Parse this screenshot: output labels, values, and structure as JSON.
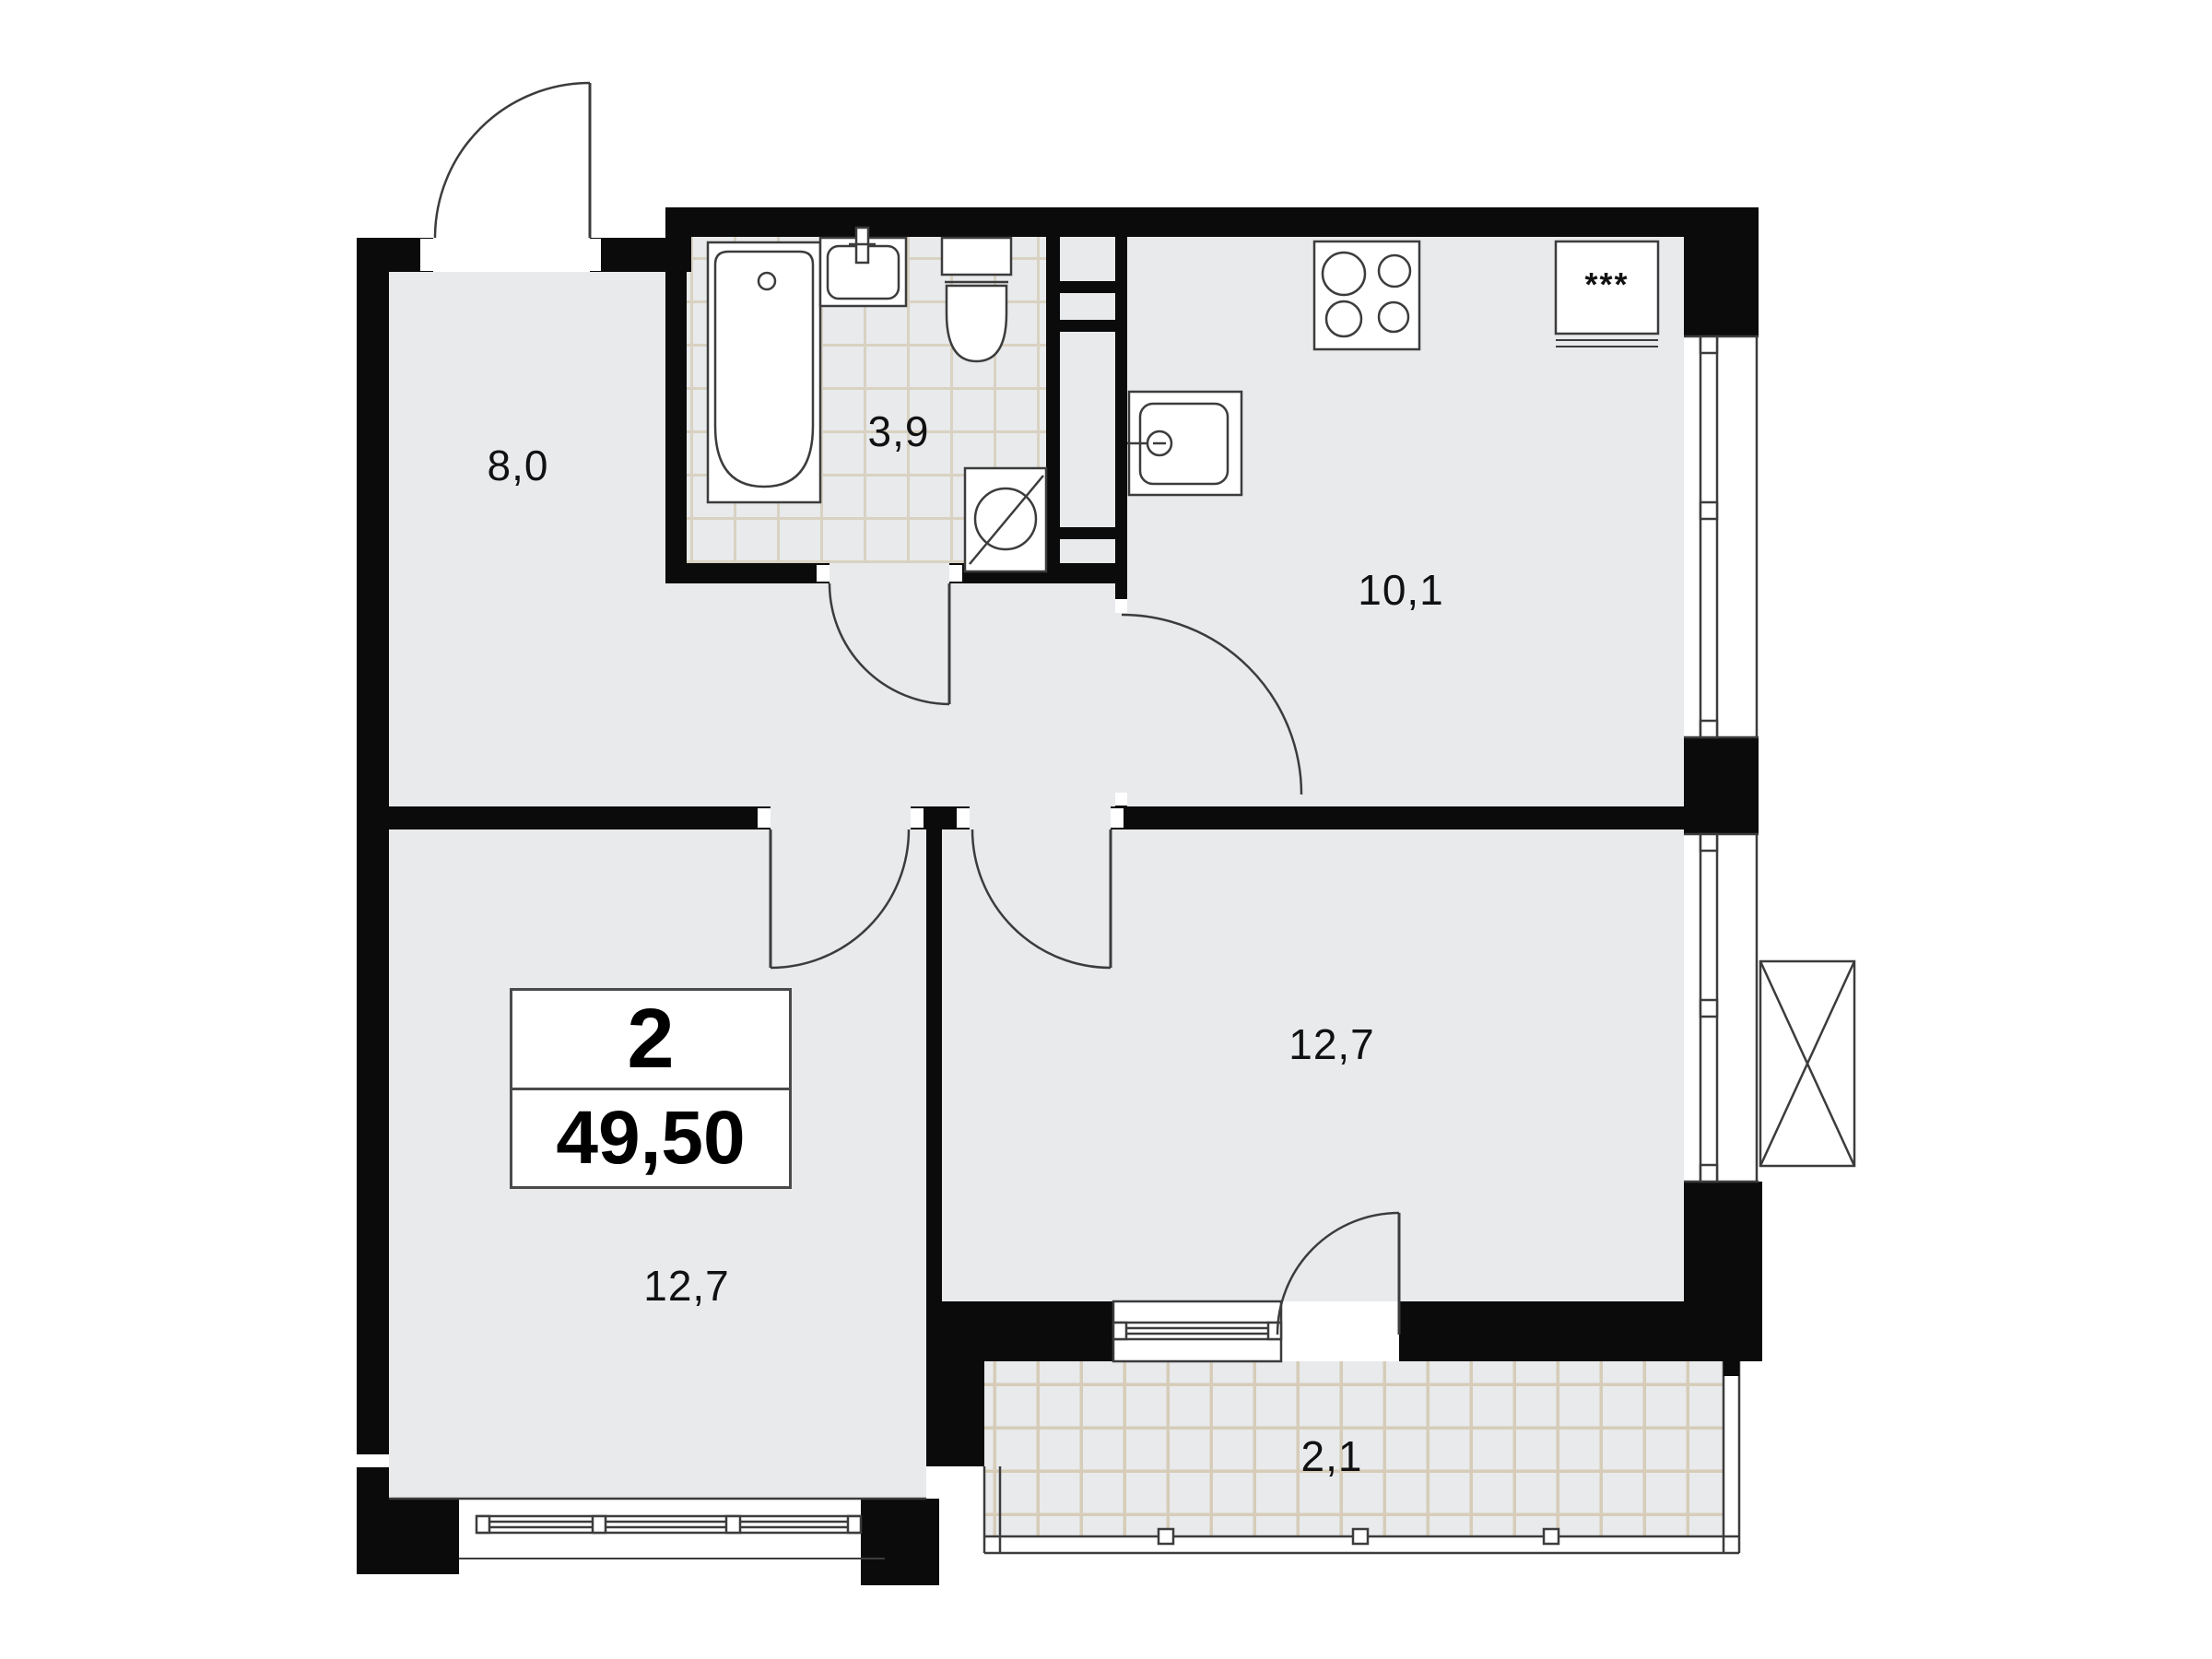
{
  "plan": {
    "title": "2-room apartment floor plan",
    "apartment": {
      "rooms_count": "2",
      "total_area": "49,50"
    },
    "rooms": [
      {
        "id": "hallway",
        "area_label": "8,0"
      },
      {
        "id": "bathroom",
        "area_label": "3,9"
      },
      {
        "id": "kitchen",
        "area_label": "10,1"
      },
      {
        "id": "living-room",
        "area_label": "12,7"
      },
      {
        "id": "bedroom",
        "area_label": "12,7"
      },
      {
        "id": "balcony",
        "area_label": "2,1"
      }
    ],
    "fixtures": {
      "fridge_label": "***"
    },
    "colors": {
      "wall": "#0b0b0b",
      "floor": "#e8eaec",
      "bath_grout": "#d9d2c2",
      "balcony_grout": "#d6ccb8",
      "outline": "#3c3c3c"
    }
  }
}
